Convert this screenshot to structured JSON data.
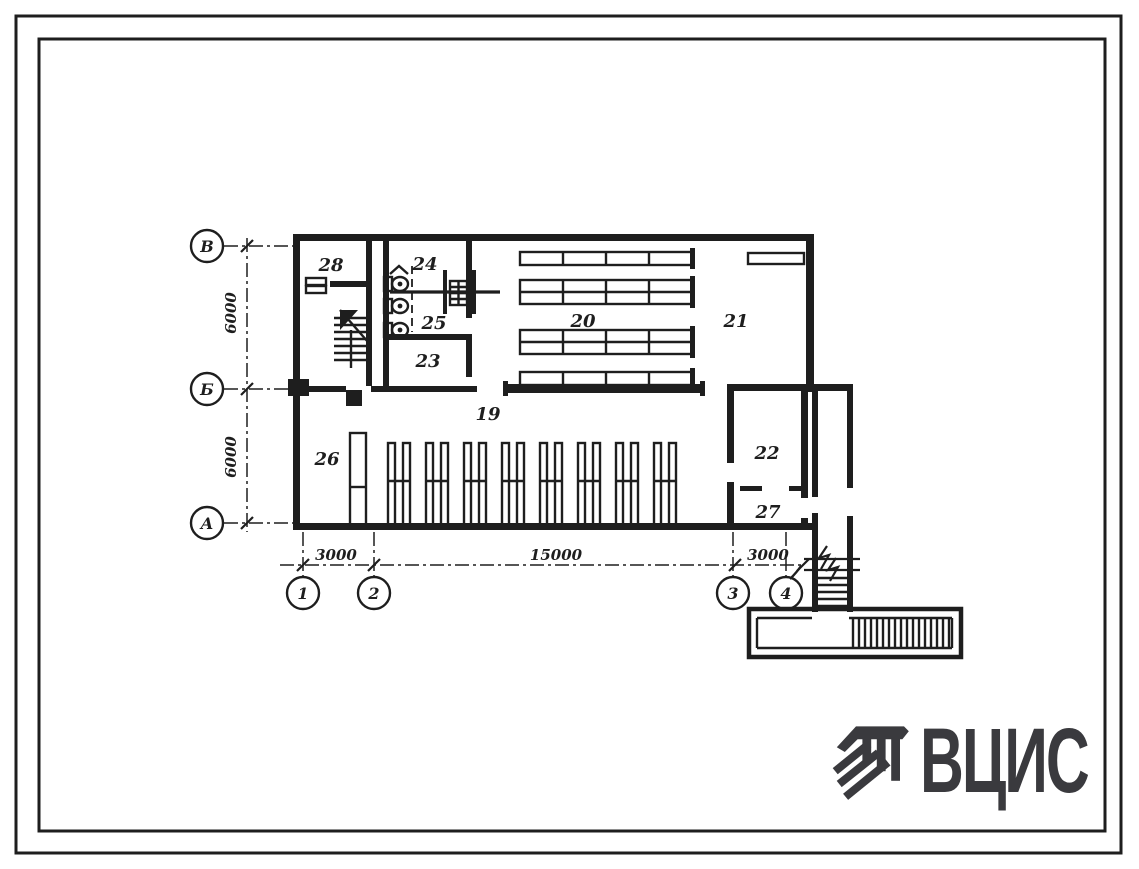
{
  "sheet": {
    "logo": {
      "text": "ВЦИС",
      "icon": "vcis-emblem"
    },
    "axis_letters": {
      "top": "В",
      "middle": "Б",
      "bottom": "А"
    },
    "axis_numbers": {
      "n1": "1",
      "n2": "2",
      "n3": "3",
      "n4": "4"
    },
    "dimensions": {
      "left_upper": "6000",
      "left_lower": "6000",
      "bottom_left": "3000",
      "bottom_middle": "15000",
      "bottom_right": "3000"
    },
    "rooms": {
      "r19": "19",
      "r20": "20",
      "r21": "21",
      "r22": "22",
      "r23": "23",
      "r24": "24",
      "r25": "25",
      "r26": "26",
      "r27": "27",
      "r28": "28"
    },
    "colors": {
      "line": "#1e1e1e",
      "logo": "#3a3a3e",
      "paper": "#ffffff"
    }
  }
}
